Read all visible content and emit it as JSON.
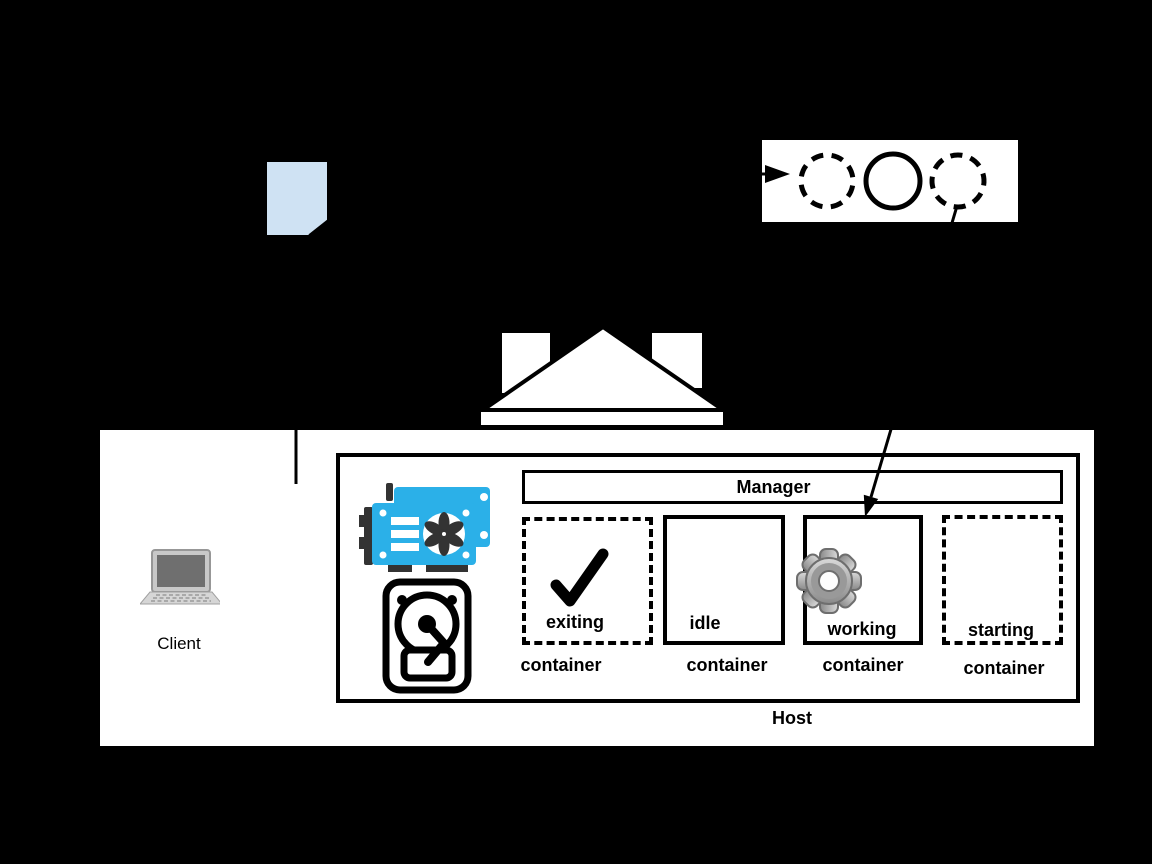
{
  "diagram_title": "containerized host with client and worker queue",
  "colors": {
    "background": "#000000",
    "panel_white": "#ffffff",
    "line_black": "#000000",
    "document_fill": "#cfe2f3",
    "gpu_blue": "#2bb0e8",
    "icon_dark": "#333333",
    "gear_gray": "#a9a9a9",
    "laptop_gray": "#c8c8c8"
  },
  "client": {
    "label": "Client",
    "icon": "laptop-icon"
  },
  "document": {
    "icon": "document-icon",
    "fill": "#cfe2f3"
  },
  "queue_box": {
    "icon": "worker-circles",
    "circles": [
      {
        "style": "dashed"
      },
      {
        "style": "solid"
      },
      {
        "style": "dashed"
      }
    ],
    "incoming_arrow": true
  },
  "gateway": {
    "icon": "bank-gateway-icon"
  },
  "host": {
    "label": "Host",
    "manager_label": "Manager",
    "resource_icons": [
      "gpu-icon",
      "hdd-icon"
    ]
  },
  "containers": [
    {
      "state": "exiting",
      "type_label": "container",
      "border": "dashed",
      "icon": "check-icon"
    },
    {
      "state": "idle",
      "type_label": "container",
      "border": "solid",
      "icon": null
    },
    {
      "state": "working",
      "type_label": "container",
      "border": "solid",
      "icon": "gear-icon"
    },
    {
      "state": "starting",
      "type_label": "container",
      "border": "dashed",
      "icon": null
    }
  ],
  "edges": [
    {
      "from": "client-document",
      "to": "host-panel",
      "style": "line"
    },
    {
      "from": "queue-dashed-circle-right",
      "to": "working-container",
      "style": "arrow"
    },
    {
      "from": "left",
      "to": "queue-box",
      "style": "arrow"
    }
  ]
}
